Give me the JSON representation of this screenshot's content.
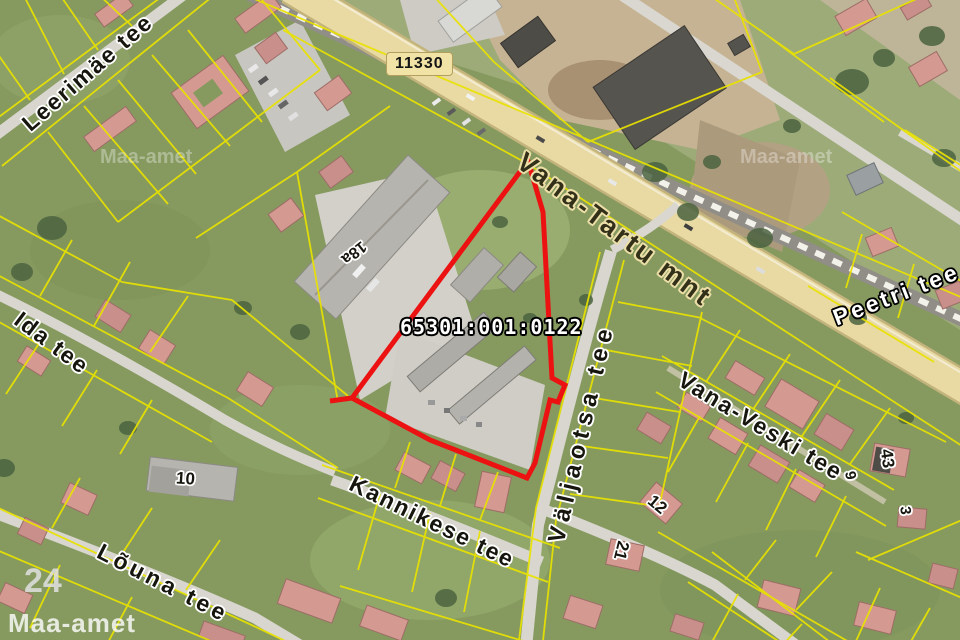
{
  "map": {
    "cadastral_code": "65301:001:0122",
    "road_number": "11330",
    "streets": {
      "vana_tartu": "Vana-Tartu mnt",
      "leerimae": "Leerimäe tee",
      "ida": "Ida tee",
      "louna": "Lõuna tee",
      "kannikese": "Kannikese tee",
      "valjaotsa": "Väljaotsa tee",
      "vana_veski": "Vana-Veski tee",
      "peetri": "Peetri tee"
    },
    "parcel_numbers": {
      "p18a": "18a",
      "p10": "10",
      "p12": "12",
      "p21": "21",
      "p43": "43",
      "p3": "3",
      "p9": "9",
      "p24": "24"
    },
    "watermark": "Maa-amet",
    "colors": {
      "parcel_line": "#e8e200",
      "selection_outline": "#ed1212",
      "highway_fill": "#e9daa3",
      "road_badge_bg": "#f1e3a6"
    }
  }
}
